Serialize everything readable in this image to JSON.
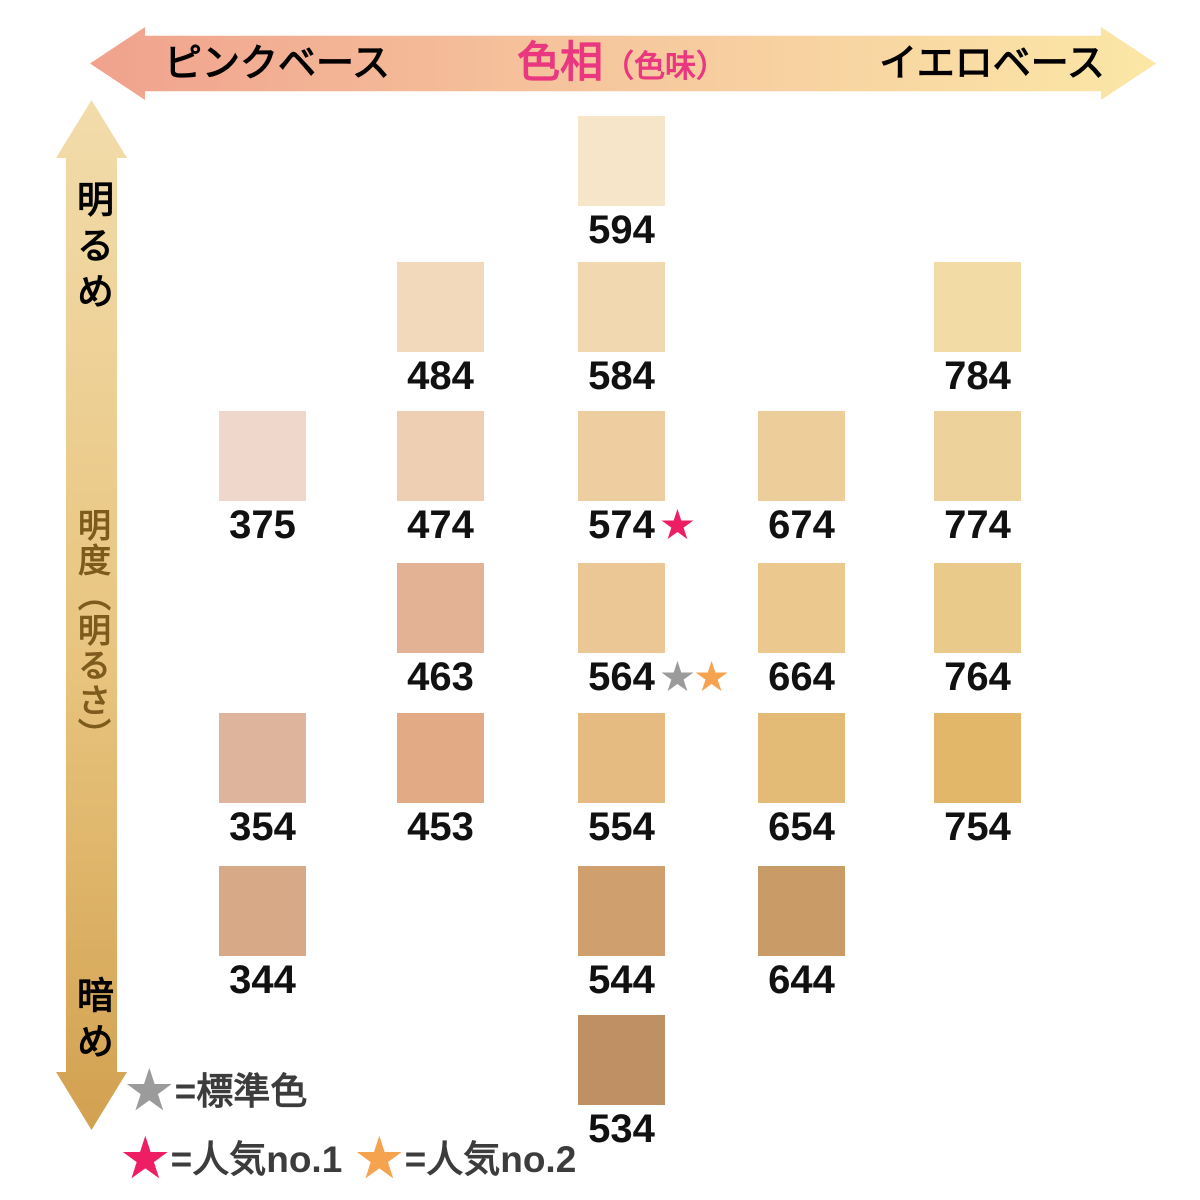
{
  "star_glyph": "★",
  "star_colors": {
    "gray": "#9b9b9b",
    "pink": "#ed1e63",
    "orange": "#f5a34f"
  },
  "axes": {
    "hue": {
      "left": "ピンクベース",
      "center": "色相",
      "center_sub": "（色味）",
      "right": "イエロベース",
      "title_color": "#e9387f",
      "gradient": [
        "#f0a28d",
        "#f6c89e",
        "#fbe7a6"
      ]
    },
    "brightness": {
      "top": "明るめ",
      "middle": "明度（明るさ）",
      "bottom": "暗め",
      "middle_color": "#7d5b1d",
      "gradient": [
        "#f2dcab",
        "#e8c47e",
        "#d2a150"
      ]
    }
  },
  "legend": [
    {
      "star": "gray",
      "label": "=標準色"
    },
    {
      "star": "pink",
      "label": "=人気no.1"
    },
    {
      "star": "orange",
      "label": "=人気no.2"
    }
  ],
  "chart_data": {
    "type": "scatter",
    "x_axis": {
      "label": "色相（色味）",
      "left_end": "ピンクベース",
      "right_end": "イエロベース"
    },
    "y_axis": {
      "label": "明度（明るさ）",
      "top_end": "明るめ",
      "bottom_end": "暗め"
    },
    "legend_position": "bottom-left",
    "points": [
      {
        "code": "594",
        "col": 3,
        "row": 1,
        "color": "#f6e5c8",
        "stars": []
      },
      {
        "code": "484",
        "col": 2,
        "row": 2,
        "color": "#f2d9bc",
        "stars": []
      },
      {
        "code": "584",
        "col": 3,
        "row": 2,
        "color": "#f2d8b0",
        "stars": []
      },
      {
        "code": "784",
        "col": 5,
        "row": 2,
        "color": "#f2dba4",
        "stars": []
      },
      {
        "code": "375",
        "col": 1,
        "row": 3,
        "color": "#efd7cb",
        "stars": []
      },
      {
        "code": "474",
        "col": 2,
        "row": 3,
        "color": "#efcfb3",
        "stars": []
      },
      {
        "code": "574",
        "col": 3,
        "row": 3,
        "color": "#eecda0",
        "stars": [
          "pink"
        ]
      },
      {
        "code": "674",
        "col": 4,
        "row": 3,
        "color": "#edcd9a",
        "stars": []
      },
      {
        "code": "774",
        "col": 5,
        "row": 3,
        "color": "#eed29b",
        "stars": []
      },
      {
        "code": "463",
        "col": 2,
        "row": 4,
        "color": "#e3b193",
        "stars": []
      },
      {
        "code": "564",
        "col": 3,
        "row": 4,
        "color": "#ebc795",
        "stars": [
          "gray",
          "orange"
        ]
      },
      {
        "code": "664",
        "col": 4,
        "row": 4,
        "color": "#eac88e",
        "stars": []
      },
      {
        "code": "764",
        "col": 5,
        "row": 4,
        "color": "#e9ca8a",
        "stars": []
      },
      {
        "code": "354",
        "col": 1,
        "row": 5,
        "color": "#dfb49c",
        "stars": []
      },
      {
        "code": "453",
        "col": 2,
        "row": 5,
        "color": "#e3aa86",
        "stars": []
      },
      {
        "code": "554",
        "col": 3,
        "row": 5,
        "color": "#e5bb82",
        "stars": []
      },
      {
        "code": "654",
        "col": 4,
        "row": 5,
        "color": "#e4ba77",
        "stars": []
      },
      {
        "code": "754",
        "col": 5,
        "row": 5,
        "color": "#e2b76a",
        "stars": []
      },
      {
        "code": "344",
        "col": 1,
        "row": 6,
        "color": "#d8a987",
        "stars": []
      },
      {
        "code": "544",
        "col": 3,
        "row": 6,
        "color": "#cf9f6e",
        "stars": []
      },
      {
        "code": "644",
        "col": 4,
        "row": 6,
        "color": "#c99b67",
        "stars": []
      },
      {
        "code": "534",
        "col": 3,
        "row": 7,
        "color": "#bf9064",
        "stars": []
      }
    ]
  }
}
